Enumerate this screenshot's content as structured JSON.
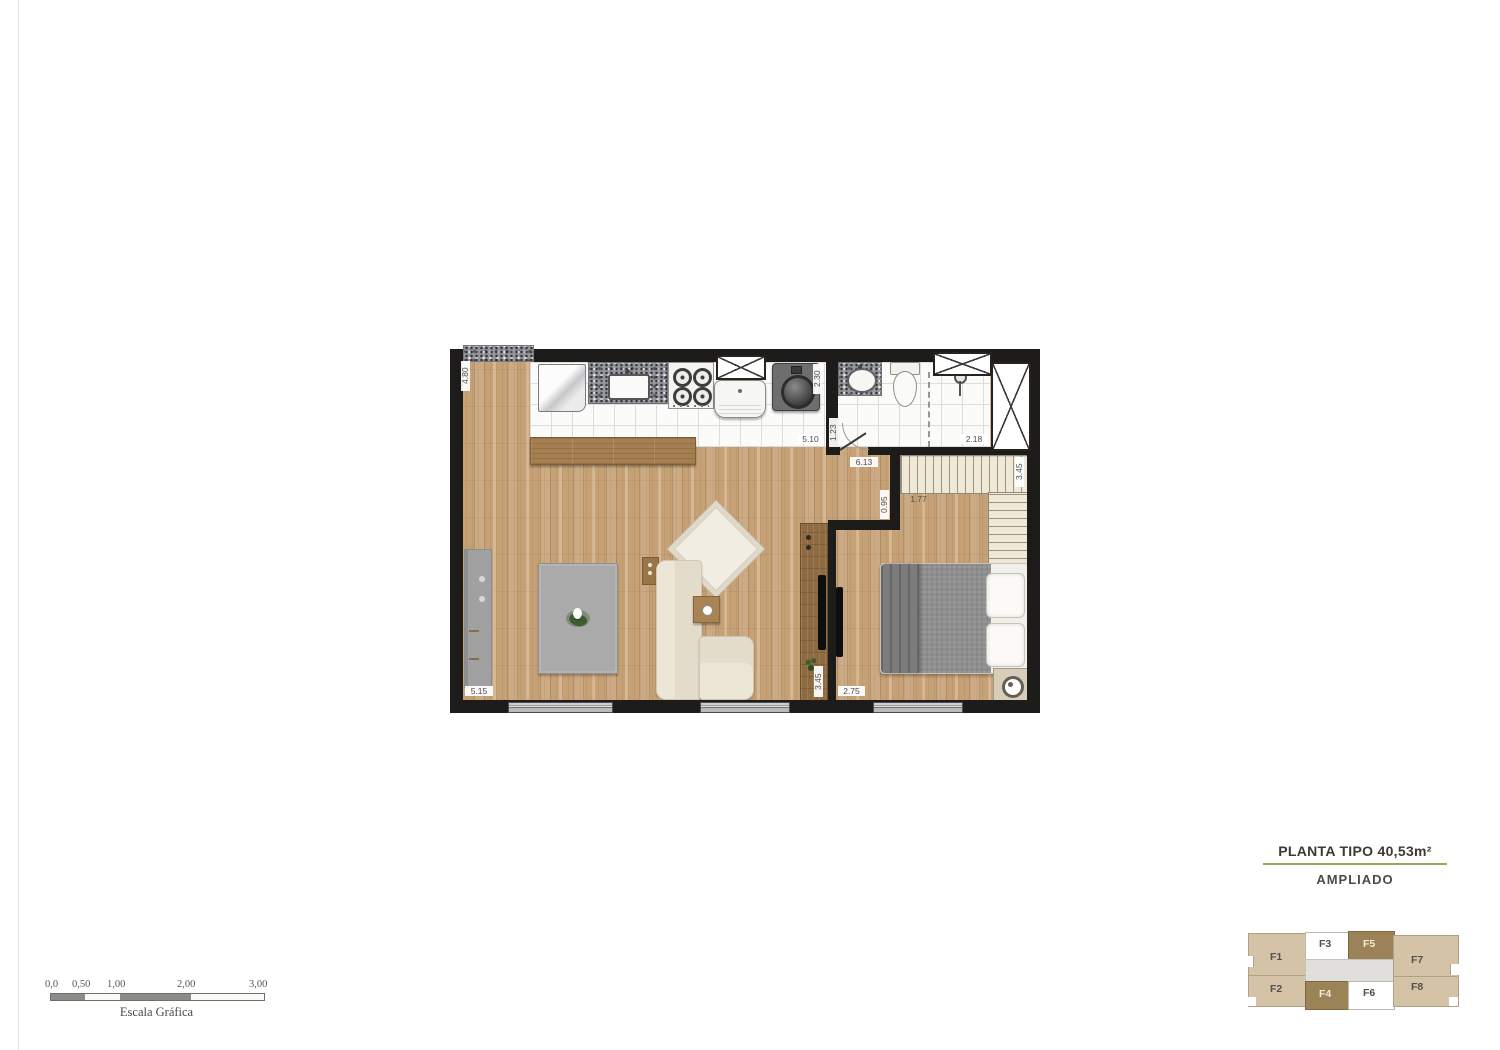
{
  "title": {
    "line1": "PLANTA TIPO 40,53m²",
    "line2": "AMPLIADO"
  },
  "plan": {
    "dims": {
      "left_height": "4.80",
      "kitchen_width": "5.10",
      "laundry_side": "2.30",
      "hall_side": "1.23",
      "bath_width": "2.18",
      "closet_height": "3.45",
      "living_length": "6.13",
      "nook_width": "0.95",
      "closet_width": "1.77",
      "living_width": "5.15",
      "tv_wall_height": "3.45",
      "bedroom_width": "2.75"
    }
  },
  "keyplan": {
    "units": [
      {
        "label": "F1",
        "type": "tan"
      },
      {
        "label": "F2",
        "type": "tan"
      },
      {
        "label": "F3",
        "type": "white"
      },
      {
        "label": "F4",
        "type": "brown"
      },
      {
        "label": "F5",
        "type": "brown"
      },
      {
        "label": "F6",
        "type": "white"
      },
      {
        "label": "F7",
        "type": "tan"
      },
      {
        "label": "F8",
        "type": "tan"
      }
    ],
    "colors": {
      "tan": "#d4c3a7",
      "brown": "#9c8257",
      "white": "#ffffff",
      "corridor": "#e0dfdc"
    }
  },
  "scalebar": {
    "ticks": [
      "0,0",
      "0,50",
      "1,00",
      "2,00",
      "3,00"
    ],
    "caption": "Escala Gráfica"
  },
  "colors": {
    "wall": "#1d1c1a",
    "wood_floor": "#c6a176",
    "title_underline": "#a5a15c"
  }
}
